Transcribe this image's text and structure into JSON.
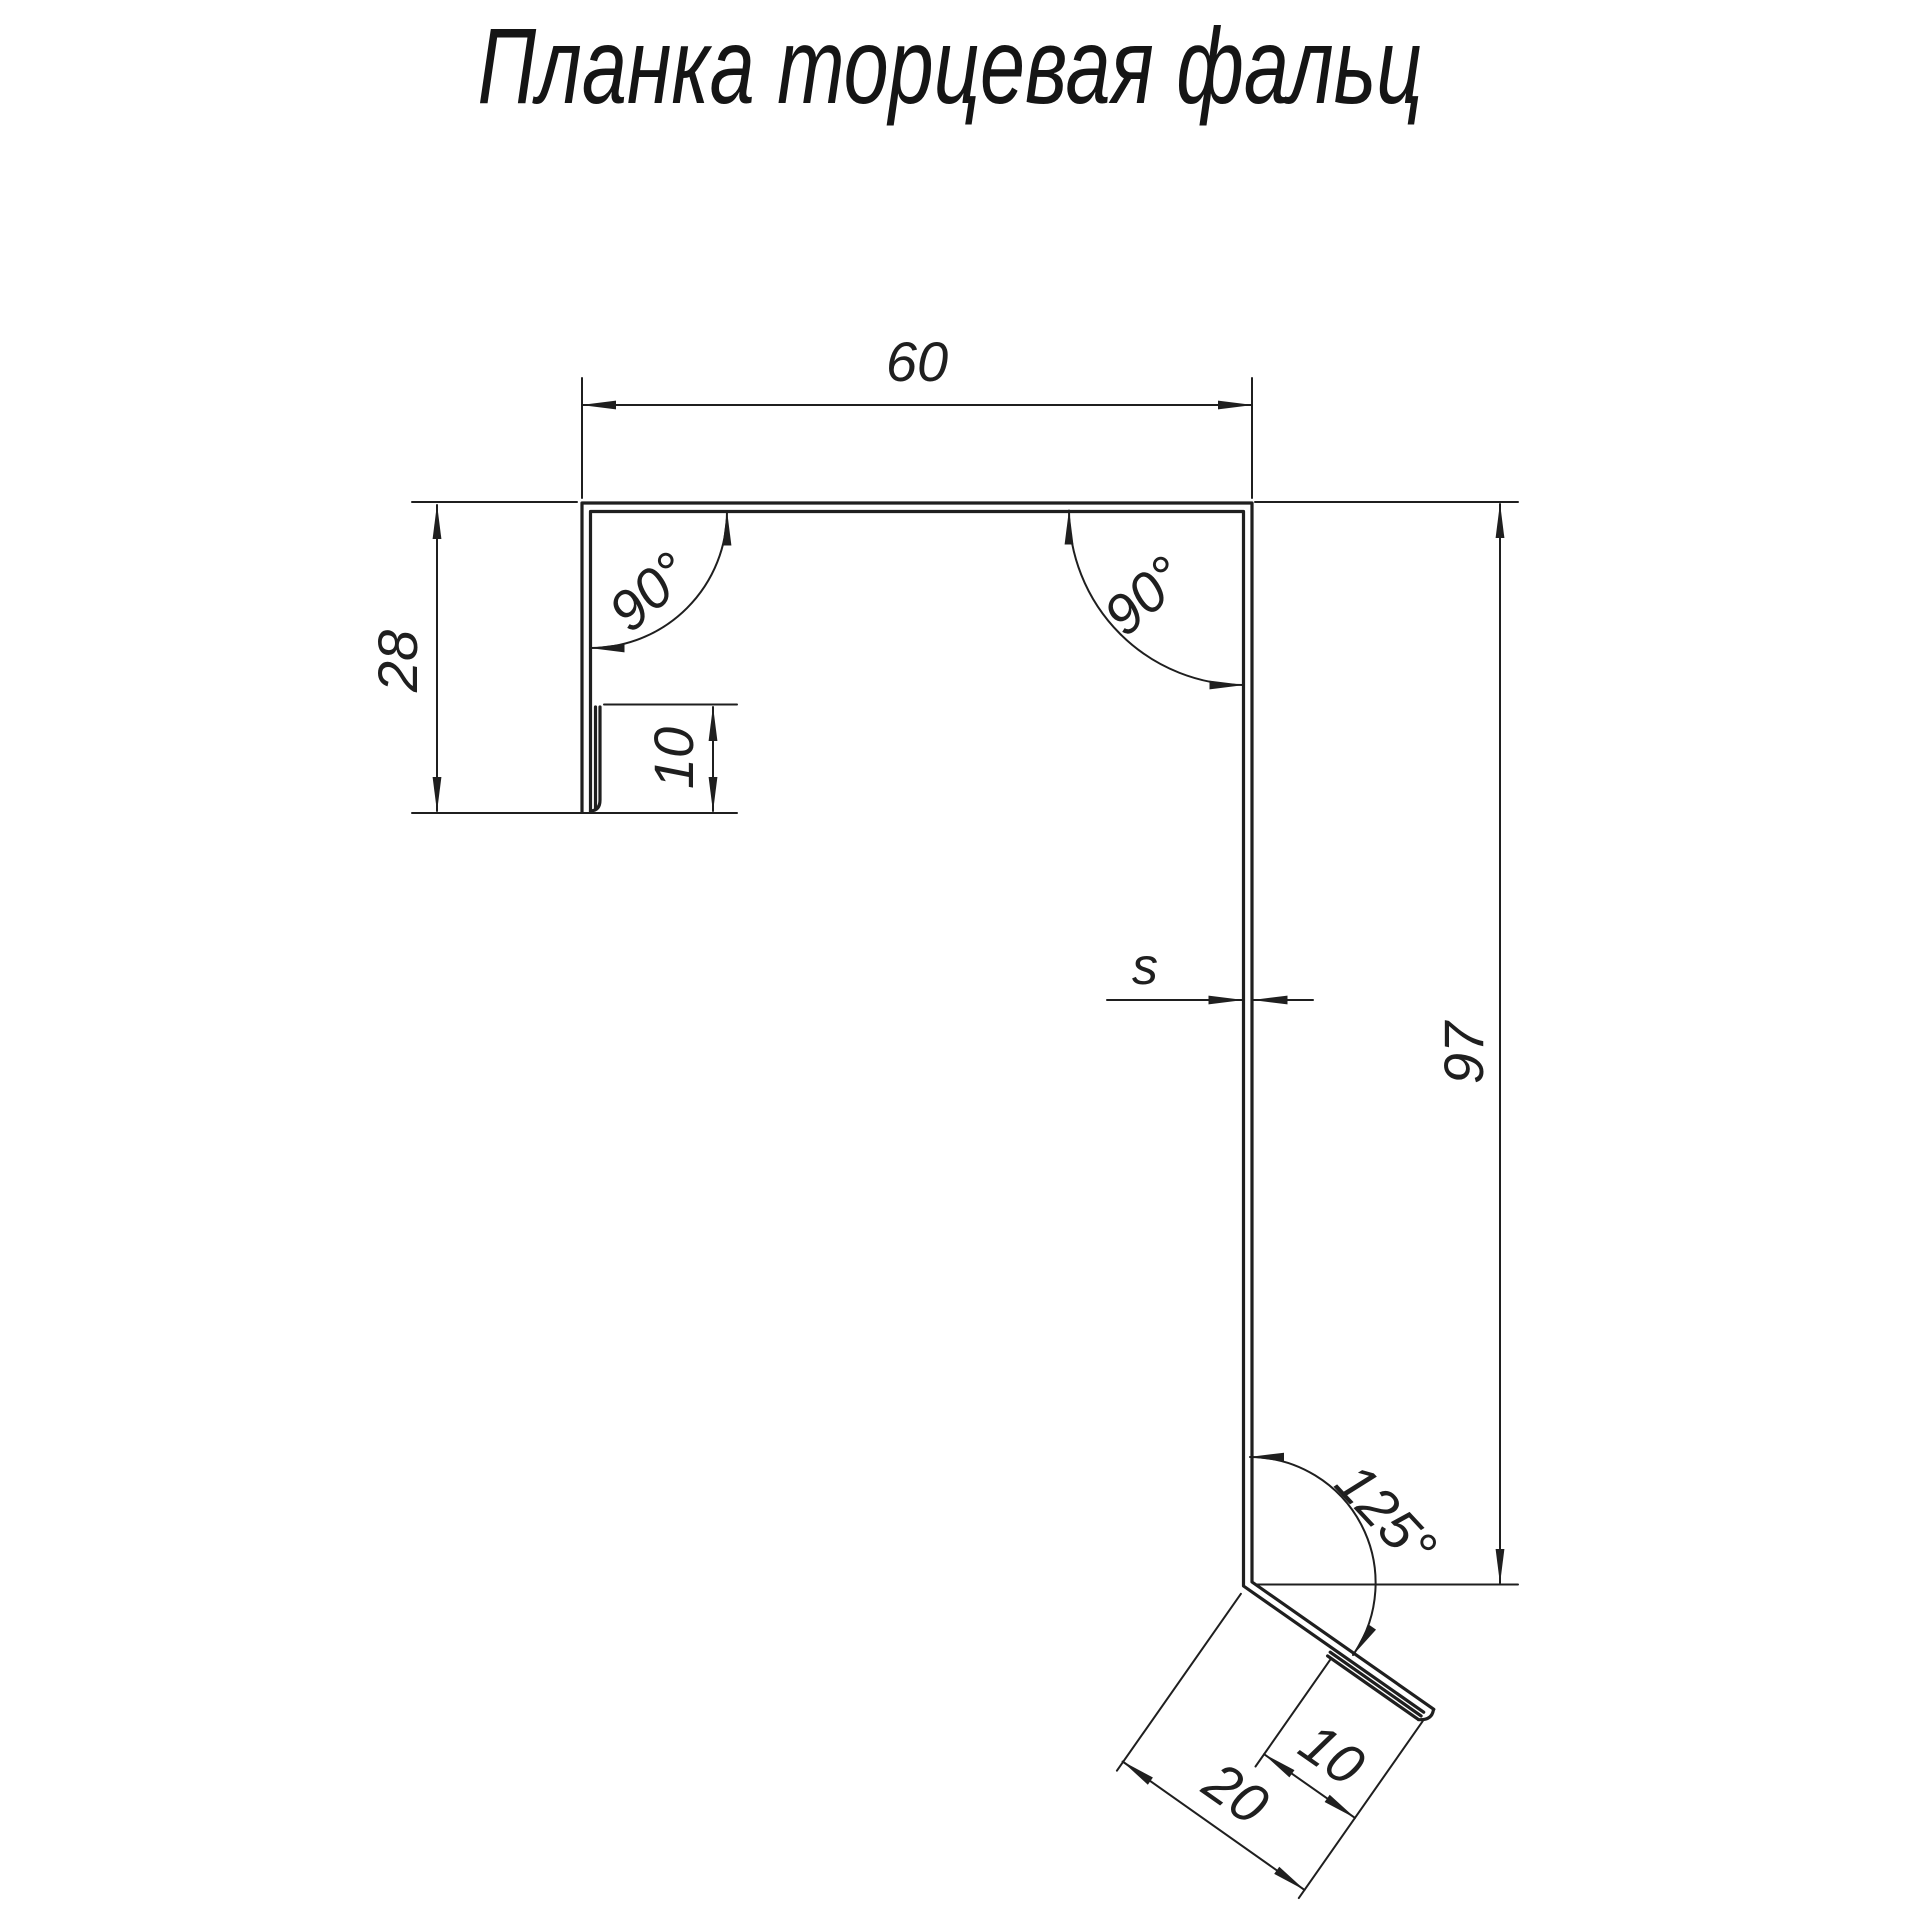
{
  "title": {
    "text": "Планка торцевая фальц"
  },
  "colors": {
    "line": "#1f1f1f",
    "background": "#ffffff"
  },
  "drawing": {
    "kind": "profile-cross-section",
    "dimensions": {
      "top_width": "60",
      "left_height": "28",
      "left_hem": "10",
      "left_corner_angle": "90°",
      "right_corner_angle": "90°",
      "sheet_thickness": "s",
      "right_height": "97",
      "bottom_bend_angle": "125°",
      "bottom_hem": "10",
      "bottom_flange_length": "20"
    }
  }
}
